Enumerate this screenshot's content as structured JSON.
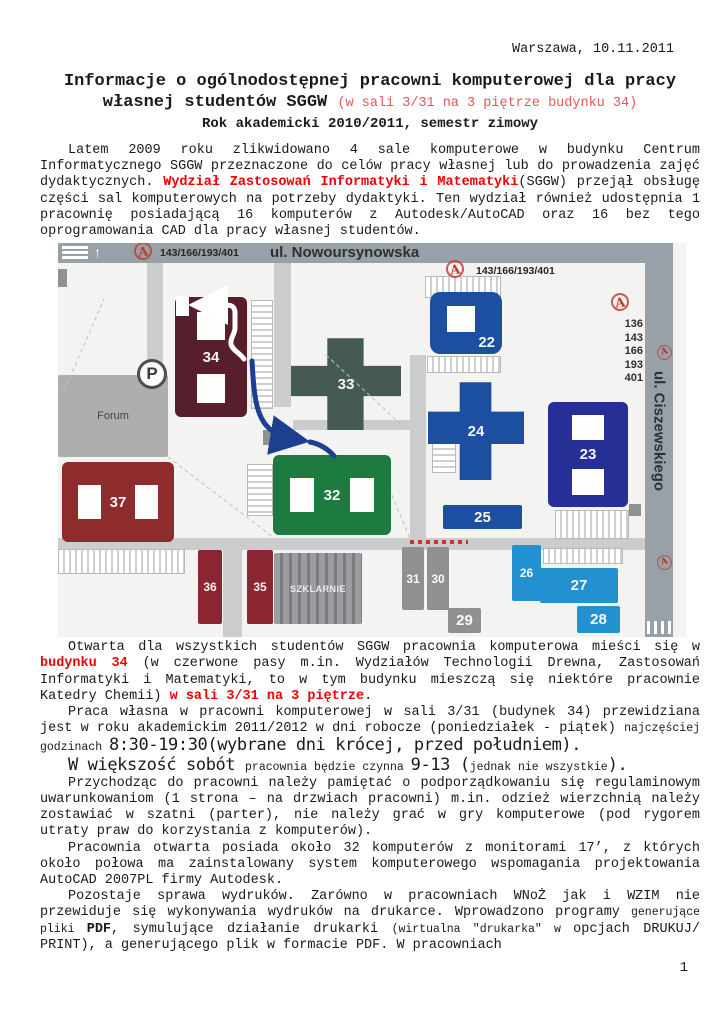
{
  "doc": {
    "date_line": "Warszawa, 10.11.2011",
    "title_line1": "Informacje o ogólnodostępnej pracowni komputerowej dla pracy",
    "title_line2_main": "własnej studentów SGGW ",
    "title_line2_red": "(w sali 3/31 na 3 piętrze budynku 34)",
    "subtitle": "Rok akademicki 2010/2011, semestr zimowy",
    "page_number": "1"
  },
  "body": {
    "p1": [
      {
        "t": "Latem 2009 roku zlikwidowano 4 sale komputerowe w budynku Centrum Informatycznego SGGW przeznaczone do celów pracy własnej lub do prowadzenia zajęć dydaktycznych. "
      },
      {
        "s": "rb",
        "t": "Wydział Zastosowań Informatyki i Matematyki"
      },
      {
        "t": "(SGGW) przejął obsługę części sal komputerowych na potrzeby dydaktyki. Ten wydział również udostępnia 1 pracownię posiadającą 16 komputerów z Autodesk/AutoCAD oraz 16 bez tego oprogramowania CAD dla pracy własnej studentów."
      }
    ],
    "p2": [
      {
        "t": "Otwarta dla wszystkich studentów SGGW pracownia komputerowa mieści się w "
      },
      {
        "s": "rb",
        "t": "budynku 34"
      },
      {
        "t": " (w czerwone pasy m.in. Wydziałów Technologii Drewna, Zastosowań Informatyki i Matematyki, to w tym budynku mieszczą się niektóre pracownie Katedry Chemii) "
      },
      {
        "s": "rb",
        "t": "w sali 3/31 na 3 piętrze"
      },
      {
        "t": "."
      }
    ],
    "p3": [
      {
        "t": "Praca własna w pracowni komputerowej w sali 3/31 (budynek 34) przewidziana jest w roku akademickim 2011/2012 w dni robocze (poniedziałek - piątek) "
      },
      {
        "s": "small",
        "t": "najczęściej godzinach "
      },
      {
        "s": "big",
        "t": "8:30-19:30(wybrane dni krócej, przed południem)."
      }
    ],
    "p4": [
      {
        "s": "big",
        "t": "W większość sobót "
      },
      {
        "s": "small",
        "t": "pracownia będzie czynna "
      },
      {
        "s": "big",
        "t": "9-13 ("
      },
      {
        "s": "small",
        "t": "jednak nie wszystkie"
      },
      {
        "s": "big",
        "t": ")."
      }
    ],
    "p5": [
      {
        "t": "Przychodząc do pracowni należy pamiętać o podporządkowaniu się regulaminowym uwarunkowaniom (1 strona – na drzwiach pracowni) m.in. odzież wierzchnią należy zostawiać w szatni (parter), nie należy grać w gry komputerowe (pod rygorem utraty praw do korzystania z komputerów)."
      }
    ],
    "p6": [
      {
        "t": "Pracownia otwarta posiada około 32 komputerów z monitorami 17’, z których około połowa ma zainstalowany system komputerowego wspomagania projektowania AutoCAD 2007PL firmy Autodesk."
      }
    ],
    "p7": [
      {
        "t": "Pozostaje sprawa wydruków. Zarówno w pracowniach WNoŻ jak i WZIM nie przewiduje się wykonywania wydruków na drukarce. Wprowadzono programy "
      },
      {
        "s": "small",
        "t": "generujące pliki "
      },
      {
        "s": "b",
        "t": "PDF"
      },
      {
        "t": ", symulujące działanie drukarki "
      },
      {
        "s": "small",
        "t": "(wirtualna \"drukarka\" w "
      },
      {
        "t": "opcjach DRUKUJ/ PRINT), a generującego plik w formacie PDF. W pracowniach"
      }
    ]
  },
  "map": {
    "street_top": "ul. Nowoursynowska",
    "street_right": "ul. Ciszewskiego",
    "bus_icon_letter": "A",
    "bus_lines_top": "143/166/193/401",
    "bus_lines_mid": "143/166/193/401",
    "bus_lines_stack": [
      "136",
      "143",
      "166",
      "193",
      "401"
    ],
    "parking_letter": "P",
    "buildings": [
      {
        "label": "34",
        "x": 117,
        "y": 54,
        "w": 72,
        "h": 120,
        "color": "#571f2c",
        "shape": "holes-v"
      },
      {
        "label": "23",
        "x": 490,
        "y": 159,
        "w": 80,
        "h": 105,
        "color": "#252f96",
        "shape": "holes-v"
      },
      {
        "label": "37",
        "x": 4,
        "y": 219,
        "w": 112,
        "h": 80,
        "color": "#8d2b2d",
        "shape": "holes-h"
      },
      {
        "label": "32",
        "x": 215,
        "y": 212,
        "w": 118,
        "h": 80,
        "color": "#1e7b40",
        "shape": "holes-h"
      },
      {
        "label": "33",
        "x": 233,
        "y": 95,
        "w": 110,
        "h": 92,
        "color": "#455a50",
        "shape": "cross"
      },
      {
        "label": "24",
        "x": 370,
        "y": 139,
        "w": 96,
        "h": 98,
        "color": "#1d4fa0",
        "shape": "cross"
      },
      {
        "label": "22",
        "x": 372,
        "y": 49,
        "w": 72,
        "h": 62,
        "color": "#1d4fa0",
        "shape": "hole-c"
      },
      {
        "label": "25",
        "x": 385,
        "y": 262,
        "w": 79,
        "h": 24,
        "color": "#1d4fa0",
        "shape": "rect"
      },
      {
        "label": "26",
        "x": 454,
        "y": 302,
        "w": 29,
        "h": 56,
        "color": "#2391d0",
        "shape": "rect"
      },
      {
        "label": "27",
        "x": 482,
        "y": 325,
        "w": 78,
        "h": 35,
        "color": "#2391d0",
        "shape": "rect"
      },
      {
        "label": "28",
        "x": 519,
        "y": 363,
        "w": 43,
        "h": 27,
        "color": "#2391d0",
        "shape": "rect"
      },
      {
        "label": "31",
        "x": 344,
        "y": 304,
        "w": 22,
        "h": 63,
        "color": "#8e9092",
        "shape": "rect"
      },
      {
        "label": "30",
        "x": 369,
        "y": 304,
        "w": 22,
        "h": 63,
        "color": "#8e9092",
        "shape": "rect"
      },
      {
        "label": "29",
        "x": 390,
        "y": 365,
        "w": 33,
        "h": 25,
        "color": "#8e9092",
        "shape": "rect"
      },
      {
        "label": "36",
        "x": 140,
        "y": 307,
        "w": 24,
        "h": 74,
        "color": "#8b2531",
        "shape": "rect"
      },
      {
        "label": "35",
        "x": 189,
        "y": 307,
        "w": 26,
        "h": 74,
        "color": "#8b2531",
        "shape": "rect"
      },
      {
        "label": "SZKLARNIE",
        "x": 216,
        "y": 310,
        "w": 88,
        "h": 71,
        "color": "#9b9da0",
        "shape": "stripes",
        "lbl": "tiny"
      },
      {
        "label": "Forum",
        "x": 0,
        "y": 132,
        "w": 110,
        "h": 82,
        "color": "#aeaeae",
        "shape": "rect",
        "lbl": "dark"
      }
    ],
    "roads": [
      {
        "x": 89,
        "y": 20,
        "w": 16,
        "h": 112
      },
      {
        "x": 216,
        "y": 20,
        "w": 17,
        "h": 144
      },
      {
        "x": 352,
        "y": 112,
        "w": 16,
        "h": 184
      },
      {
        "x": 0,
        "y": 295,
        "w": 587,
        "h": 12
      },
      {
        "x": 165,
        "y": 307,
        "w": 19,
        "h": 87
      },
      {
        "x": 235,
        "y": 177,
        "w": 117,
        "h": 10
      }
    ],
    "decorations": [
      {
        "cls": "hatch-h",
        "x": 193,
        "y": 57,
        "w": 20,
        "h": 107
      },
      {
        "cls": "hatch-v",
        "x": 367,
        "y": 33,
        "w": 74,
        "h": 20
      },
      {
        "cls": "hatch-v",
        "x": 369,
        "y": 113,
        "w": 72,
        "h": 15
      },
      {
        "cls": "hatch-h",
        "x": 374,
        "y": 194,
        "w": 22,
        "h": 34
      },
      {
        "cls": "hatch-v",
        "x": 497,
        "y": 267,
        "w": 72,
        "h": 27
      },
      {
        "cls": "hatch-v",
        "x": 485,
        "y": 305,
        "w": 78,
        "h": 14
      },
      {
        "cls": "hatch-v",
        "x": 0,
        "y": 306,
        "w": 125,
        "h": 23
      },
      {
        "cls": "hatch-h",
        "x": 189,
        "y": 221,
        "w": 24,
        "h": 50
      },
      {
        "cls": "grayblock",
        "x": 571,
        "y": 261,
        "w": 12,
        "h": 12
      },
      {
        "cls": "grayblock",
        "x": 205,
        "y": 187,
        "w": 8,
        "h": 15
      },
      {
        "cls": "grayblock",
        "x": 0,
        "y": 26,
        "w": 9,
        "h": 18
      },
      {
        "cls": "reddots",
        "x": 352,
        "y": 297,
        "w": 58,
        "h": 4
      }
    ]
  },
  "colors": {
    "accent_red_bold": "#ee0000",
    "title_red": "#e05858",
    "route_blue": "#1c3f90",
    "main_road_gray": "#98a1a7",
    "minor_road_gray": "#cacccd",
    "building_34_maroon": "#571f2c",
    "building_32_green": "#1e7b40",
    "building_23_navy": "#252f96"
  }
}
